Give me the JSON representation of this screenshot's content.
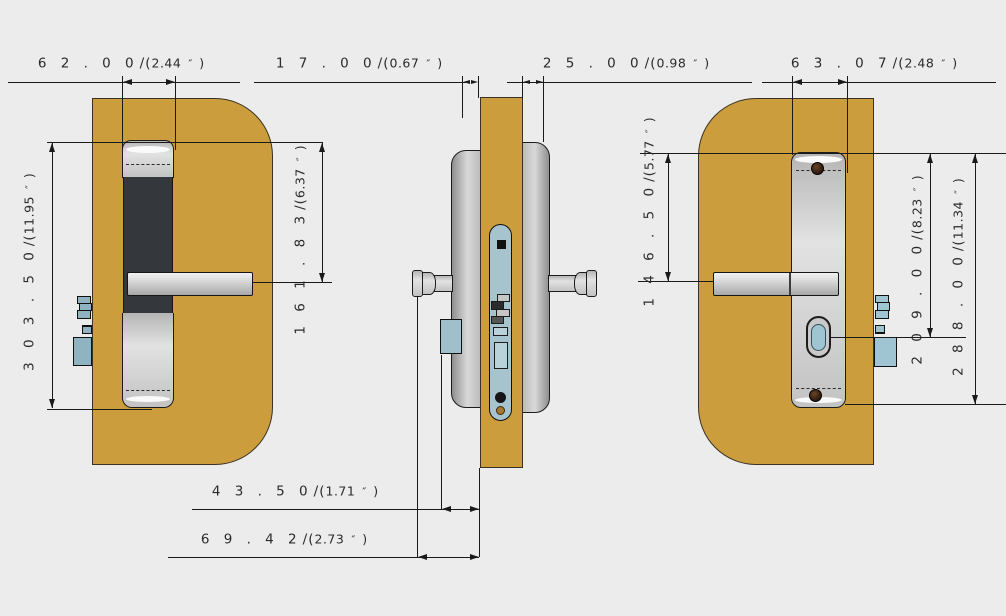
{
  "drawing": {
    "subject": "door-lock-technical-drawing",
    "colors": {
      "background": "#ececec",
      "door_wood": "#cb9d3d",
      "door_outline": "#3a3222",
      "plate_silver": "#c9c9c9",
      "keypad_dark": "#34383d",
      "faceplate_blue": "#a7c4ce",
      "bolt_blue": "#8fb3bf",
      "cylinder_blue": "#9fc4d2",
      "bronze": "#a9782f",
      "dimension_line": "#1a1a1a",
      "text": "#2b2b2b"
    }
  },
  "format": {
    "open": "/(",
    "mark": "″",
    "close": ")"
  },
  "dims": [
    {
      "mm": "6 2 . 0 0",
      "inch": "2.44"
    },
    {
      "mm": "1 7 . 0 0",
      "inch": "0.67"
    },
    {
      "mm": "2 5 . 0 0",
      "inch": "0.98"
    },
    {
      "mm": "6 3 . 0 7",
      "inch": "2.48"
    },
    {
      "mm": "3 0 3 . 5 0",
      "inch": "11.95"
    },
    {
      "mm": "1 6 1 . 8 3",
      "inch": "6.37"
    },
    {
      "mm": "1 4 6 . 5 0",
      "inch": "5.77"
    },
    {
      "mm": "2 0 9 . 0 0",
      "inch": "8.23"
    },
    {
      "mm": "2 8 8 . 0 0",
      "inch": "11.34"
    },
    {
      "mm": "4 3 . 5 0",
      "inch": "1.71"
    },
    {
      "mm": "6 9 . 4 2",
      "inch": "2.73"
    }
  ]
}
